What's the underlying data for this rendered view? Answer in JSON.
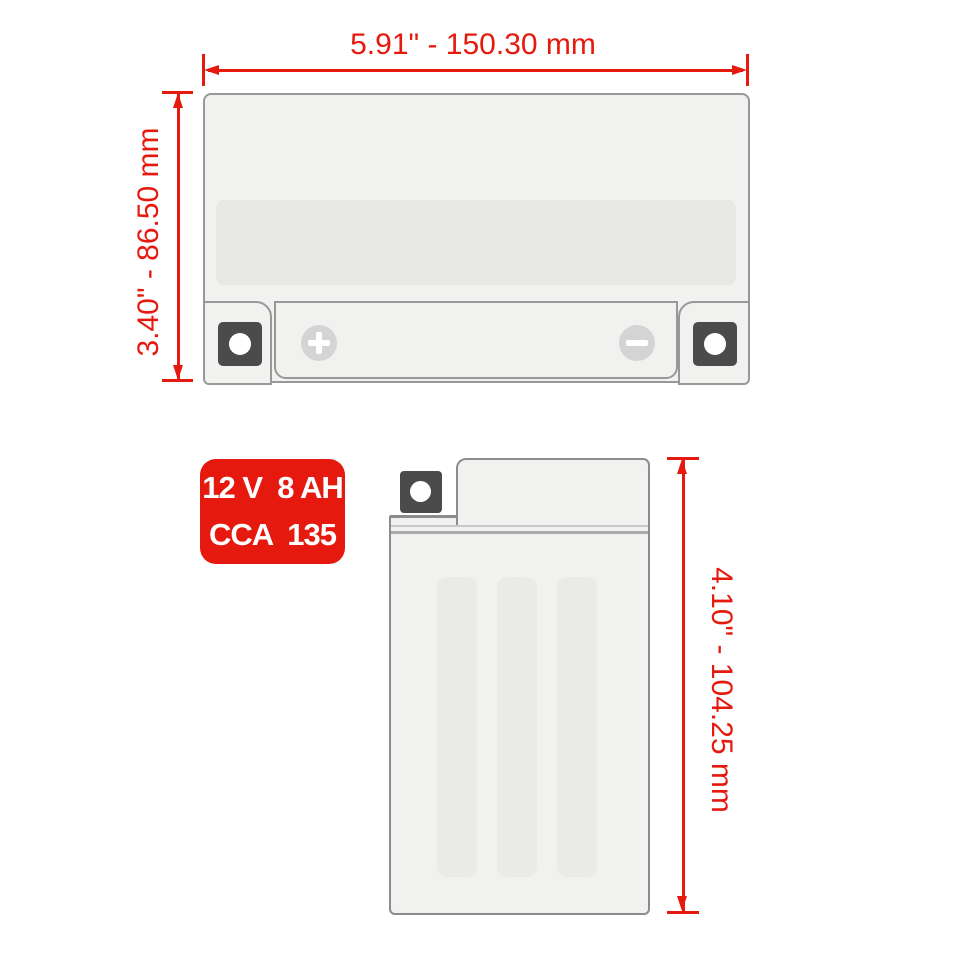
{
  "diagram": {
    "type": "battery-dimension-diagram",
    "colors": {
      "dimension_red": "#e6190e",
      "battery_body": "#f1f1f0",
      "battery_recess": "#e8e8e7",
      "terminal_dark": "#4b4b4b",
      "outline_gray": "#989898",
      "badge_background": "#e6190e",
      "badge_text": "#ffffff"
    },
    "top_view": {
      "width_label": "5.91\" - 150.30 mm",
      "height_label": "3.40\" - 86.50 mm",
      "positive_terminal_symbol": "+",
      "negative_terminal_symbol": "−"
    },
    "side_view": {
      "height_label": "4.10\" - 104.25 mm"
    },
    "badge": {
      "line1": "12 V  8 AH",
      "line2": "CCA  135"
    }
  }
}
